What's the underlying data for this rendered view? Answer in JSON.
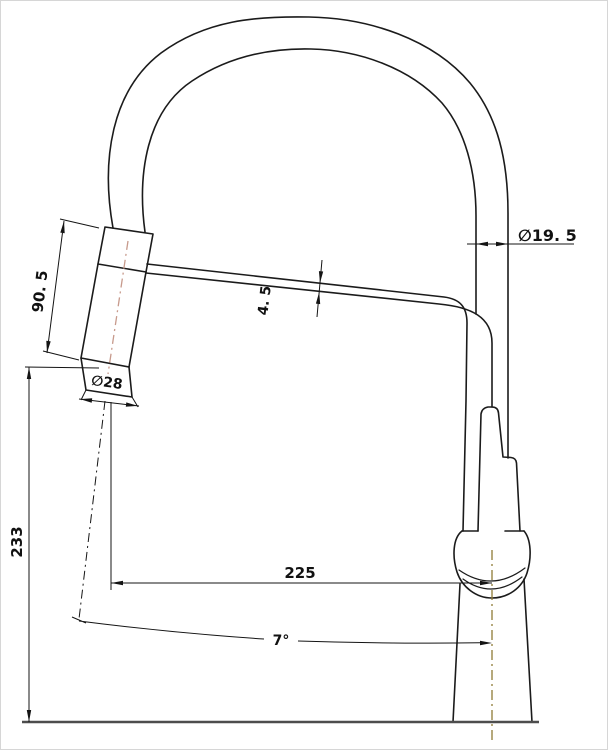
{
  "drawing": {
    "title": "kitchen-faucet-technical-drawing-side-elevation",
    "labels": {
      "spout_diameter": "∅19. 5",
      "sprayhead_length": "90. 5",
      "hose_thickness": "4. 5",
      "sprayhead_diameter": "∅28",
      "overall_height": "233",
      "reach": "225",
      "angle": "7°"
    },
    "colors": {
      "outline": "#1b1b1b",
      "dimension": "#141414",
      "sprayhead_centerline": "#c79a8c",
      "body_centerline": "#8f7b35",
      "deck_line": "#4d4d4d",
      "background": "#ffffff"
    }
  }
}
